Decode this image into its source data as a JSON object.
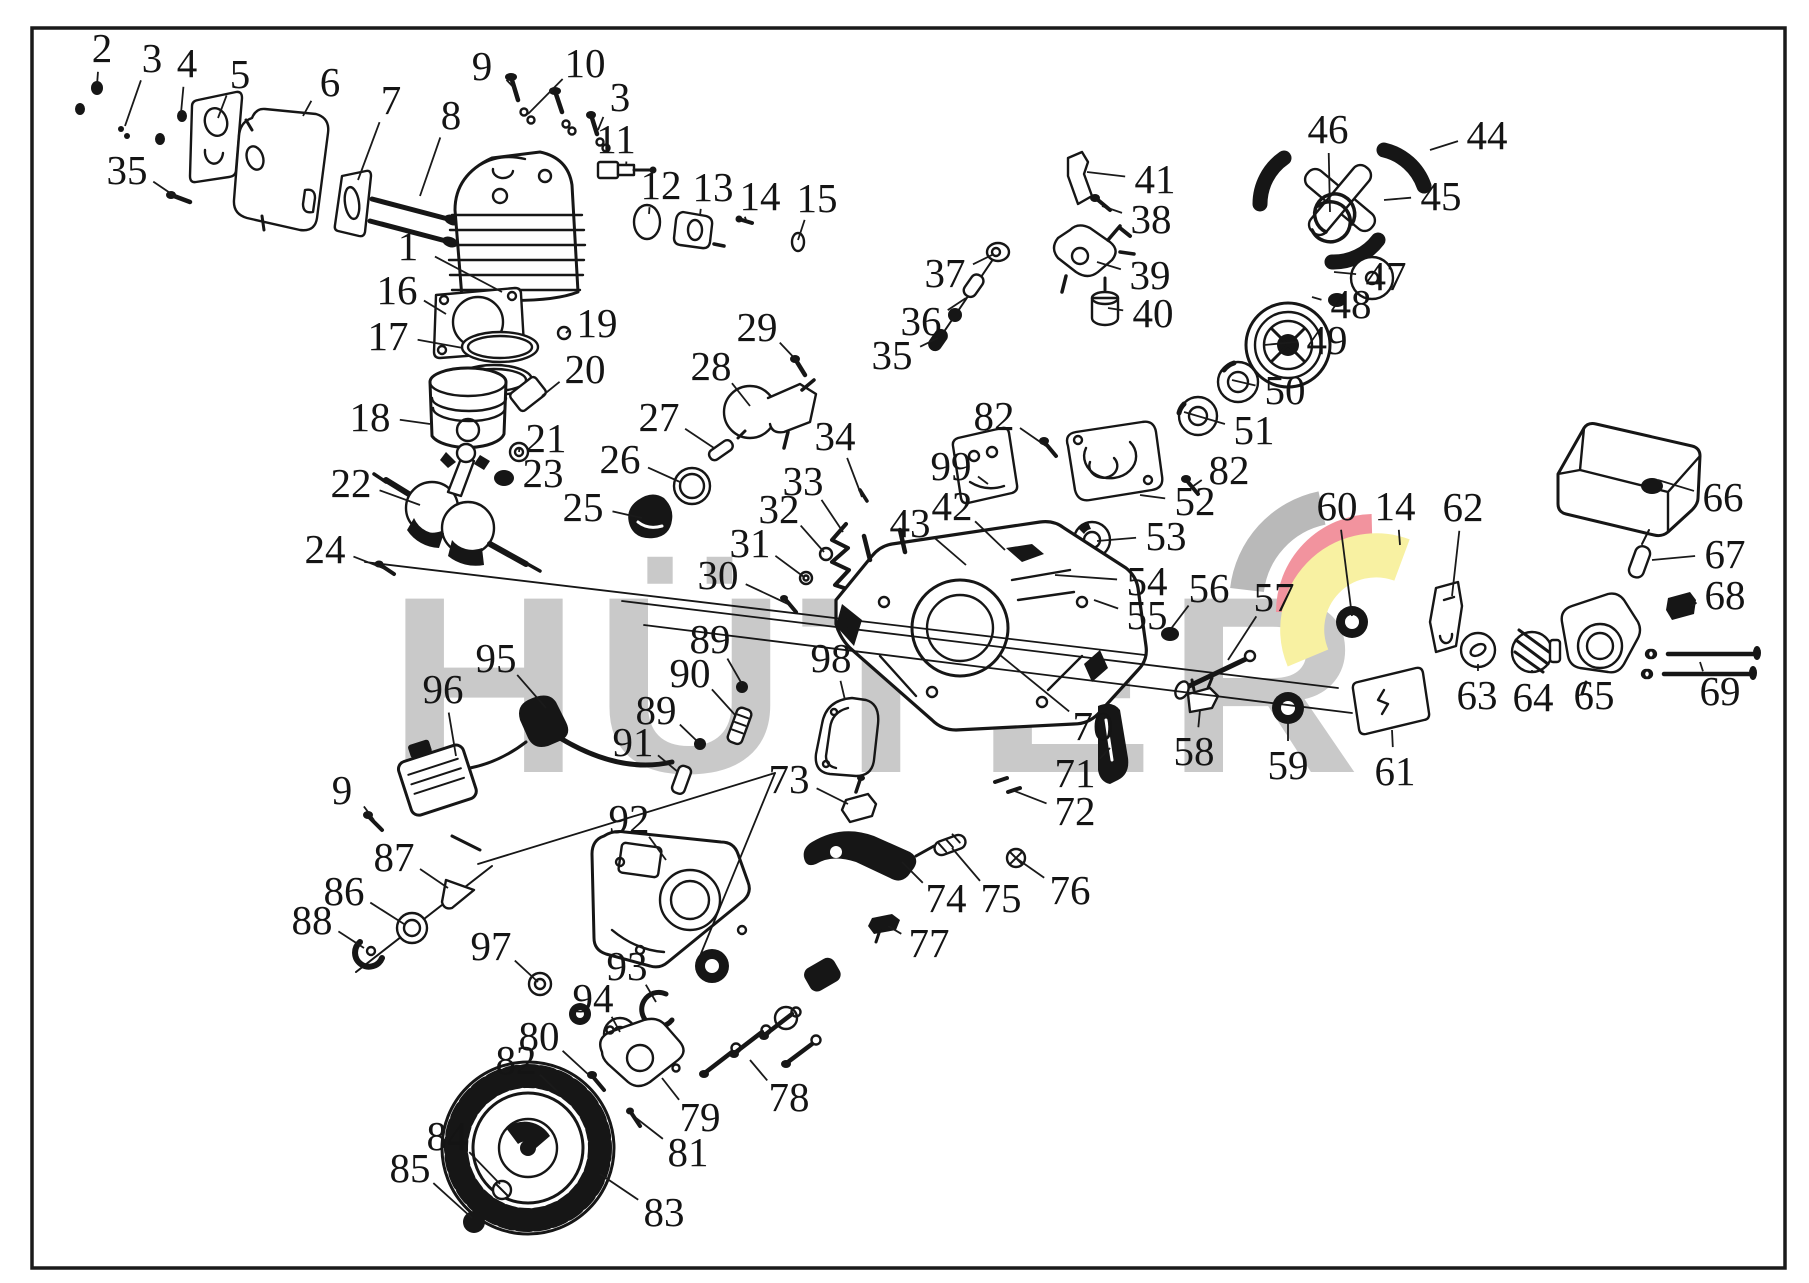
{
  "meta": {
    "kind": "exploded-parts-diagram",
    "subject": "chainsaw engine parts"
  },
  "watermark": {
    "text": "HÜTER",
    "color": "#c9c9c9"
  },
  "brand": {
    "swoosh": {
      "gray": "#b9b9b9",
      "red": "#f2939e",
      "yellow": "#f8f1a2"
    }
  },
  "diagram": {
    "background": "#ffffff",
    "border_color": "#1a1a1a",
    "labels": [
      {
        "t": "2",
        "x": 102,
        "y": 48,
        "tx": 97,
        "ty": 85
      },
      {
        "t": "3",
        "x": 152,
        "y": 58,
        "tx": 125,
        "ty": 126
      },
      {
        "t": "4",
        "x": 187,
        "y": 63,
        "tx": 181,
        "ty": 113
      },
      {
        "t": "5",
        "x": 240,
        "y": 74,
        "tx": 218,
        "ty": 118
      },
      {
        "t": "6",
        "x": 330,
        "y": 82,
        "tx": 303,
        "ty": 116
      },
      {
        "t": "7",
        "x": 391,
        "y": 100,
        "tx": 358,
        "ty": 180
      },
      {
        "t": "8",
        "x": 451,
        "y": 115,
        "tx": 420,
        "ty": 196
      },
      {
        "t": "9",
        "x": 482,
        "y": 66,
        "tx": 516,
        "ty": 90
      },
      {
        "t": "10",
        "x": 585,
        "y": 63,
        "tx": 528,
        "ty": 114
      },
      {
        "t": "3",
        "x": 620,
        "y": 97,
        "tx": 598,
        "ty": 130
      },
      {
        "t": "11",
        "x": 616,
        "y": 139,
        "tx": 626,
        "ty": 166
      },
      {
        "t": "12",
        "x": 661,
        "y": 185,
        "tx": 649,
        "ty": 214
      },
      {
        "t": "13",
        "x": 713,
        "y": 187,
        "tx": 700,
        "ty": 216
      },
      {
        "t": "14",
        "x": 760,
        "y": 196,
        "tx": 746,
        "ty": 220
      },
      {
        "t": "15",
        "x": 817,
        "y": 198,
        "tx": 798,
        "ty": 240
      },
      {
        "t": "1",
        "x": 408,
        "y": 246,
        "tx": 502,
        "ty": 292
      },
      {
        "t": "16",
        "x": 397,
        "y": 290,
        "tx": 446,
        "ty": 314
      },
      {
        "t": "17",
        "x": 388,
        "y": 336,
        "tx": 463,
        "ty": 348
      },
      {
        "t": "19",
        "x": 597,
        "y": 323,
        "tx": 566,
        "ty": 333
      },
      {
        "t": "20",
        "x": 585,
        "y": 369,
        "tx": 542,
        "ty": 396
      },
      {
        "t": "18",
        "x": 370,
        "y": 417,
        "tx": 430,
        "ty": 424
      },
      {
        "t": "21",
        "x": 546,
        "y": 438,
        "tx": 519,
        "ty": 452
      },
      {
        "t": "23",
        "x": 543,
        "y": 473,
        "tx": 510,
        "ty": 478
      },
      {
        "t": "22",
        "x": 351,
        "y": 483,
        "tx": 420,
        "ty": 505
      },
      {
        "t": "24",
        "x": 325,
        "y": 549,
        "tx": 388,
        "ty": 570
      },
      {
        "t": "29",
        "x": 757,
        "y": 327,
        "tx": 799,
        "ty": 363
      },
      {
        "t": "28",
        "x": 711,
        "y": 366,
        "tx": 750,
        "ty": 406
      },
      {
        "t": "27",
        "x": 659,
        "y": 417,
        "tx": 714,
        "ty": 448
      },
      {
        "t": "26",
        "x": 620,
        "y": 459,
        "tx": 680,
        "ty": 482
      },
      {
        "t": "25",
        "x": 583,
        "y": 507,
        "tx": 642,
        "ty": 518
      },
      {
        "t": "34",
        "x": 835,
        "y": 436,
        "tx": 862,
        "ty": 497
      },
      {
        "t": "33",
        "x": 803,
        "y": 481,
        "tx": 843,
        "ty": 532
      },
      {
        "t": "32",
        "x": 779,
        "y": 509,
        "tx": 824,
        "ty": 552
      },
      {
        "t": "31",
        "x": 750,
        "y": 543,
        "tx": 804,
        "ty": 577
      },
      {
        "t": "30",
        "x": 718,
        "y": 575,
        "tx": 788,
        "ty": 604
      },
      {
        "t": "41",
        "x": 1155,
        "y": 179,
        "tx": 1087,
        "ty": 172
      },
      {
        "t": "38",
        "x": 1151,
        "y": 219,
        "tx": 1102,
        "ty": 206
      },
      {
        "t": "39",
        "x": 1150,
        "y": 275,
        "tx": 1097,
        "ty": 262
      },
      {
        "t": "40",
        "x": 1153,
        "y": 313,
        "tx": 1108,
        "ty": 308
      },
      {
        "t": "37",
        "x": 945,
        "y": 273,
        "tx": 994,
        "ty": 254
      },
      {
        "t": "36",
        "x": 921,
        "y": 321,
        "tx": 966,
        "ty": 298
      },
      {
        "t": "35",
        "x": 892,
        "y": 355,
        "tx": 938,
        "ty": 338
      },
      {
        "t": "35",
        "x": 127,
        "y": 170,
        "tx": 176,
        "ty": 197
      },
      {
        "t": "46",
        "x": 1328,
        "y": 129,
        "tx": 1330,
        "ty": 212
      },
      {
        "t": "44",
        "x": 1487,
        "y": 135,
        "tx": 1430,
        "ty": 150
      },
      {
        "t": "45",
        "x": 1441,
        "y": 196,
        "tx": 1384,
        "ty": 200
      },
      {
        "t": "47",
        "x": 1386,
        "y": 276,
        "tx": 1334,
        "ty": 272
      },
      {
        "t": "48",
        "x": 1351,
        "y": 304,
        "tx": 1312,
        "ty": 297
      },
      {
        "t": "49",
        "x": 1327,
        "y": 340,
        "tx": 1264,
        "ty": 345
      },
      {
        "t": "50",
        "x": 1285,
        "y": 390,
        "tx": 1232,
        "ty": 380
      },
      {
        "t": "51",
        "x": 1254,
        "y": 430,
        "tx": 1184,
        "ty": 412
      },
      {
        "t": "82",
        "x": 994,
        "y": 416,
        "tx": 1046,
        "ty": 446
      },
      {
        "t": "82",
        "x": 1229,
        "y": 470,
        "tx": 1192,
        "ty": 487
      },
      {
        "t": "99",
        "x": 951,
        "y": 466,
        "tx": 988,
        "ty": 484
      },
      {
        "t": "52",
        "x": 1195,
        "y": 501,
        "tx": 1140,
        "ty": 495
      },
      {
        "t": "53",
        "x": 1166,
        "y": 536,
        "tx": 1097,
        "ty": 541
      },
      {
        "t": "54",
        "x": 1147,
        "y": 581,
        "tx": 1055,
        "ty": 575
      },
      {
        "t": "55",
        "x": 1147,
        "y": 615,
        "tx": 1094,
        "ty": 600
      },
      {
        "t": "42",
        "x": 952,
        "y": 506,
        "tx": 1005,
        "ty": 550
      },
      {
        "t": "43",
        "x": 910,
        "y": 523,
        "tx": 966,
        "ty": 565
      },
      {
        "t": "56",
        "x": 1209,
        "y": 588,
        "tx": 1170,
        "ty": 630
      },
      {
        "t": "57",
        "x": 1274,
        "y": 597,
        "tx": 1228,
        "ty": 660
      },
      {
        "t": "60",
        "x": 1337,
        "y": 506,
        "tx": 1352,
        "ty": 616
      },
      {
        "t": "14",
        "x": 1395,
        "y": 506,
        "tx": 1400,
        "ty": 545
      },
      {
        "t": "62",
        "x": 1463,
        "y": 507,
        "tx": 1452,
        "ty": 596
      },
      {
        "t": "66",
        "x": 1723,
        "y": 497,
        "tx": 1658,
        "ty": 480
      },
      {
        "t": "67",
        "x": 1725,
        "y": 554,
        "tx": 1652,
        "ty": 560
      },
      {
        "t": "68",
        "x": 1725,
        "y": 595,
        "tx": 1692,
        "ty": 606
      },
      {
        "t": "69",
        "x": 1720,
        "y": 691,
        "tx": 1700,
        "ty": 662
      },
      {
        "t": "63",
        "x": 1477,
        "y": 695,
        "tx": 1478,
        "ty": 664
      },
      {
        "t": "64",
        "x": 1533,
        "y": 697,
        "tx": 1532,
        "ty": 670
      },
      {
        "t": "65",
        "x": 1594,
        "y": 695,
        "tx": 1598,
        "ty": 670
      },
      {
        "t": "61",
        "x": 1395,
        "y": 771,
        "tx": 1392,
        "ty": 730
      },
      {
        "t": "59",
        "x": 1288,
        "y": 765,
        "tx": 1288,
        "ty": 720
      },
      {
        "t": "58",
        "x": 1194,
        "y": 751,
        "tx": 1200,
        "ty": 710
      },
      {
        "t": "70",
        "x": 1093,
        "y": 726,
        "tx": 1000,
        "ty": 655
      },
      {
        "t": "71",
        "x": 1075,
        "y": 773,
        "tx": 1110,
        "ty": 748
      },
      {
        "t": "72",
        "x": 1075,
        "y": 811,
        "tx": 1012,
        "ty": 790
      },
      {
        "t": "89",
        "x": 710,
        "y": 639,
        "tx": 742,
        "ty": 684
      },
      {
        "t": "90",
        "x": 690,
        "y": 673,
        "tx": 736,
        "ty": 716
      },
      {
        "t": "89",
        "x": 656,
        "y": 710,
        "tx": 698,
        "ty": 742
      },
      {
        "t": "91",
        "x": 633,
        "y": 742,
        "tx": 678,
        "ty": 772
      },
      {
        "t": "98",
        "x": 831,
        "y": 658,
        "tx": 845,
        "ty": 700
      },
      {
        "t": "95",
        "x": 496,
        "y": 658,
        "tx": 546,
        "ty": 708
      },
      {
        "t": "96",
        "x": 443,
        "y": 689,
        "tx": 456,
        "ty": 756
      },
      {
        "t": "9",
        "x": 342,
        "y": 790,
        "tx": 374,
        "ty": 820
      },
      {
        "t": "92",
        "x": 629,
        "y": 819,
        "tx": 666,
        "ty": 860
      },
      {
        "t": "73",
        "x": 789,
        "y": 779,
        "tx": 848,
        "ty": 804
      },
      {
        "t": "87",
        "x": 394,
        "y": 857,
        "tx": 448,
        "ty": 888
      },
      {
        "t": "86",
        "x": 344,
        "y": 891,
        "tx": 404,
        "ty": 924
      },
      {
        "t": "88",
        "x": 312,
        "y": 920,
        "tx": 364,
        "ty": 948
      },
      {
        "t": "74",
        "x": 946,
        "y": 898,
        "tx": 902,
        "ty": 862
      },
      {
        "t": "75",
        "x": 1001,
        "y": 898,
        "tx": 952,
        "ty": 848
      },
      {
        "t": "76",
        "x": 1070,
        "y": 890,
        "tx": 1016,
        "ty": 858
      },
      {
        "t": "77",
        "x": 929,
        "y": 943,
        "tx": 888,
        "ty": 926
      },
      {
        "t": "97",
        "x": 491,
        "y": 946,
        "tx": 538,
        "ty": 982
      },
      {
        "t": "93",
        "x": 627,
        "y": 966,
        "tx": 656,
        "ty": 1002
      },
      {
        "t": "94",
        "x": 593,
        "y": 998,
        "tx": 620,
        "ty": 1032
      },
      {
        "t": "80",
        "x": 539,
        "y": 1036,
        "tx": 590,
        "ty": 1076
      },
      {
        "t": "82",
        "x": 516,
        "y": 1060,
        "tx": 558,
        "ty": 1092
      },
      {
        "t": "78",
        "x": 789,
        "y": 1097,
        "tx": 750,
        "ty": 1060
      },
      {
        "t": "79",
        "x": 700,
        "y": 1117,
        "tx": 662,
        "ty": 1078
      },
      {
        "t": "81",
        "x": 688,
        "y": 1152,
        "tx": 636,
        "ty": 1118
      },
      {
        "t": "84",
        "x": 447,
        "y": 1136,
        "tx": 500,
        "ty": 1184
      },
      {
        "t": "85",
        "x": 410,
        "y": 1168,
        "tx": 472,
        "ty": 1218
      },
      {
        "t": "83",
        "x": 664,
        "y": 1212,
        "tx": 600,
        "ty": 1174
      }
    ]
  }
}
